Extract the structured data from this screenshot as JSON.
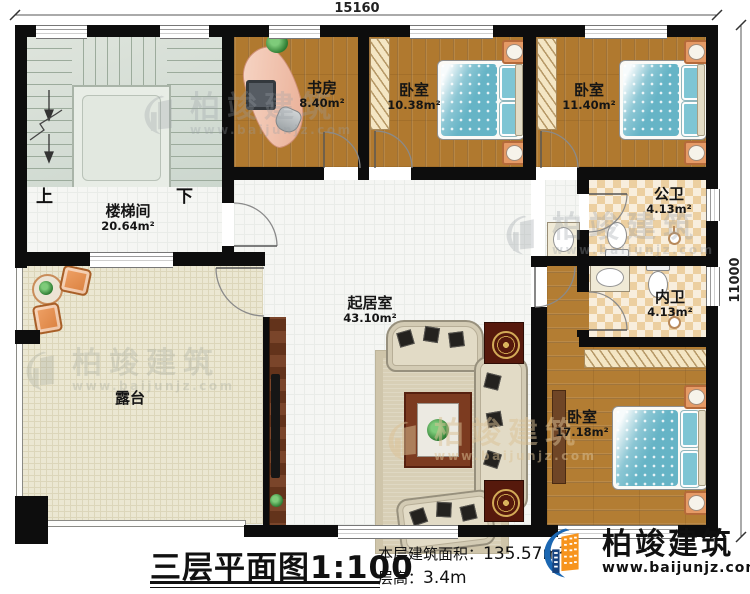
{
  "dimensions": {
    "top": "15160",
    "right": "11000"
  },
  "rooms": {
    "study": {
      "name": "书房",
      "area": "8.40m²"
    },
    "bedroom1": {
      "name": "卧室",
      "area": "10.38m²"
    },
    "bedroom2": {
      "name": "卧室",
      "area": "11.40m²"
    },
    "stairwell": {
      "name": "楼梯间",
      "area": "20.64m²"
    },
    "public_bath": {
      "name": "公卫",
      "area": "4.13m²"
    },
    "inner_bath": {
      "name": "内卫",
      "area": "4.13m²"
    },
    "living": {
      "name": "起居室",
      "area": "43.10m²"
    },
    "terrace": {
      "name": "露台"
    },
    "bedroom3": {
      "name": "卧室",
      "area": "17.18m²"
    }
  },
  "stairs": {
    "up": "上",
    "down": "下"
  },
  "title": {
    "plan_name": "三层平面图",
    "scale": "1:100",
    "area_label": "本层建筑面积：",
    "area_value": "135.57m²",
    "floor_height_label": "层高：",
    "floor_height_value": "3.4m"
  },
  "brand": {
    "name": "柏竣建筑",
    "url": "www.baijunjz.com"
  }
}
